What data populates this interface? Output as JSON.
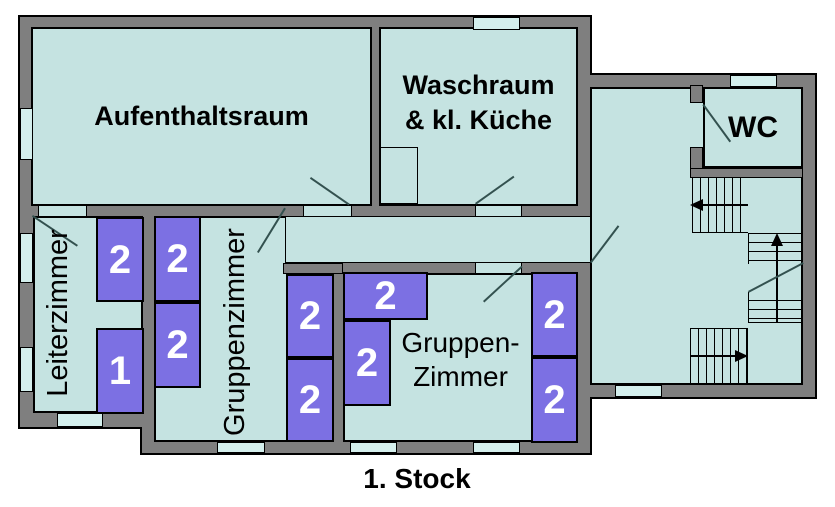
{
  "floor_label": "1. Stock",
  "rooms": {
    "aufenthaltsraum": {
      "label": "Aufenthaltsraum"
    },
    "waschraum": {
      "label_line1": "Waschraum",
      "label_line2": "& kl. Küche"
    },
    "wc": {
      "label": "WC"
    },
    "leiterzimmer": {
      "label": "Leiterzimmer"
    },
    "gruppenzimmer_mitte": {
      "label": "Gruppenzimmer"
    },
    "gruppenzimmer_gross": {
      "label_line1": "Gruppen-",
      "label_line2": "Zimmer"
    }
  },
  "beds": [
    {
      "room": "leiterzimmer",
      "capacity": "2"
    },
    {
      "room": "leiterzimmer",
      "capacity": "1"
    },
    {
      "room": "gruppenzimmer_mitte",
      "capacity": "2"
    },
    {
      "room": "gruppenzimmer_mitte",
      "capacity": "2"
    },
    {
      "room": "gruppenzimmer_mitte",
      "capacity": "2"
    },
    {
      "room": "gruppenzimmer_mitte",
      "capacity": "2"
    },
    {
      "room": "gruppenzimmer_gross",
      "capacity": "2"
    },
    {
      "room": "gruppenzimmer_gross",
      "capacity": "2"
    },
    {
      "room": "gruppenzimmer_gross",
      "capacity": "2"
    },
    {
      "room": "gruppenzimmer_gross",
      "capacity": "2"
    }
  ],
  "colors": {
    "wall": "#7f7f7f",
    "room": "#c5e3e1",
    "window": "#d4efed",
    "bed": "#7c70e3",
    "bed_number": "#ffffff",
    "outline": "#000000",
    "door_line": "#33514f"
  }
}
